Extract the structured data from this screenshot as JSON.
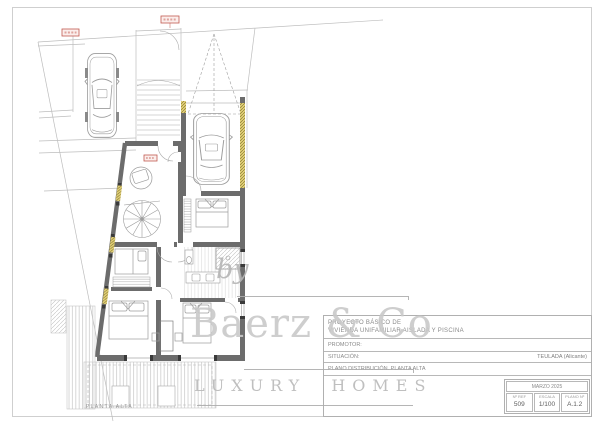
{
  "drawing": {
    "plan_label": "PLANTA ALTA",
    "colors": {
      "wall": "#6c6c6c",
      "thin_line": "#a8a8a8",
      "site_line": "#bdbdbd",
      "window_yellow": "#e2d178",
      "marker_red": "#c25a50",
      "hatch_gray": "#c6c6c6"
    }
  },
  "watermark": {
    "by": "by",
    "name": "Baerz & Co",
    "tagline": "LUXURY HOMES"
  },
  "title_block": {
    "project_label": "PROYECTO BÁSICO DE",
    "project_name": "VIVIENDA UNIFAMILIAR AISLADA Y PISCINA",
    "promoter_label": "PROMOTOR:",
    "location_label": "SITUACIÓN:",
    "location_value": "TEULADA (Alicante)",
    "sheet_title": "PLANO DISTRIBUCIÓN. PLANTA ALTA",
    "date": "MARZO 2025",
    "ref_label": "Nº REF",
    "ref_value": "509",
    "scale_label": "ESCALA",
    "scale_value": "1/100",
    "plan_no_label": "PLANO Nº",
    "plan_no_value": "A.1.2"
  }
}
